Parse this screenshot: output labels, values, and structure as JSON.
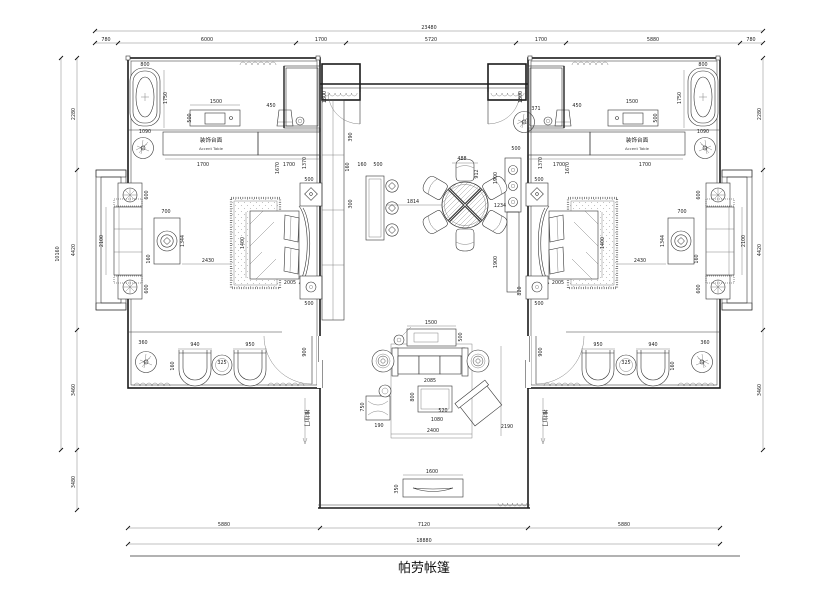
{
  "title": {
    "name": "帕劳帐篷"
  },
  "labels": {
    "accent_cn": "装饰台面",
    "accent_en": "Accent Table",
    "sliding_door": "推拉门"
  },
  "dims": {
    "top": [
      "780",
      "6000",
      "1700",
      "5720",
      "1700",
      "5880",
      "780"
    ],
    "top_total": "23480",
    "bottom": [
      "5880",
      "7120",
      "5880"
    ],
    "bottom_total": "18880",
    "left": [
      "2280",
      "4420",
      "3460"
    ],
    "left_total": "10160",
    "left_lower": "3480",
    "right": [
      "2280",
      "4420",
      "3460"
    ],
    "bath": {
      "tub_w": "800",
      "tub_len": "1750",
      "tub_base": "1090",
      "vanity_w": "1500",
      "vanity_d": "500",
      "stool": "450",
      "shower": "1800",
      "accent": "1700"
    },
    "bedroom": {
      "side_table": "600",
      "daybed": "2100",
      "table_w": "700",
      "table_h": "1344",
      "gap": "160",
      "bed_w": "2430",
      "bed_len": "1400",
      "nightstand": "500",
      "wall_a": "1670",
      "wall_b": "1370",
      "bed_edge": "2005"
    },
    "hall": {
      "a": "390",
      "b": "160",
      "c": "300",
      "console_d": "160",
      "console_w": "500",
      "table_gap": "1814",
      "chair": "488",
      "d": "912",
      "plant": "371",
      "r1": "500",
      "r2": "1900",
      "r3": "1234",
      "r4": "820"
    },
    "living": {
      "console_w": "1500",
      "console_d": "500",
      "sofa": "2085",
      "coffee": "800",
      "coffee_b": "520",
      "coffee_c": "1080",
      "rug_w": "2400",
      "rug_h": "2190",
      "bench": "750",
      "bench_b": "190",
      "tv": "1600",
      "tv_d": "350"
    },
    "strip": {
      "plant": "360",
      "chair_a": "940",
      "table": "325",
      "chair_b": "950",
      "depth": "160",
      "door": "900"
    }
  }
}
